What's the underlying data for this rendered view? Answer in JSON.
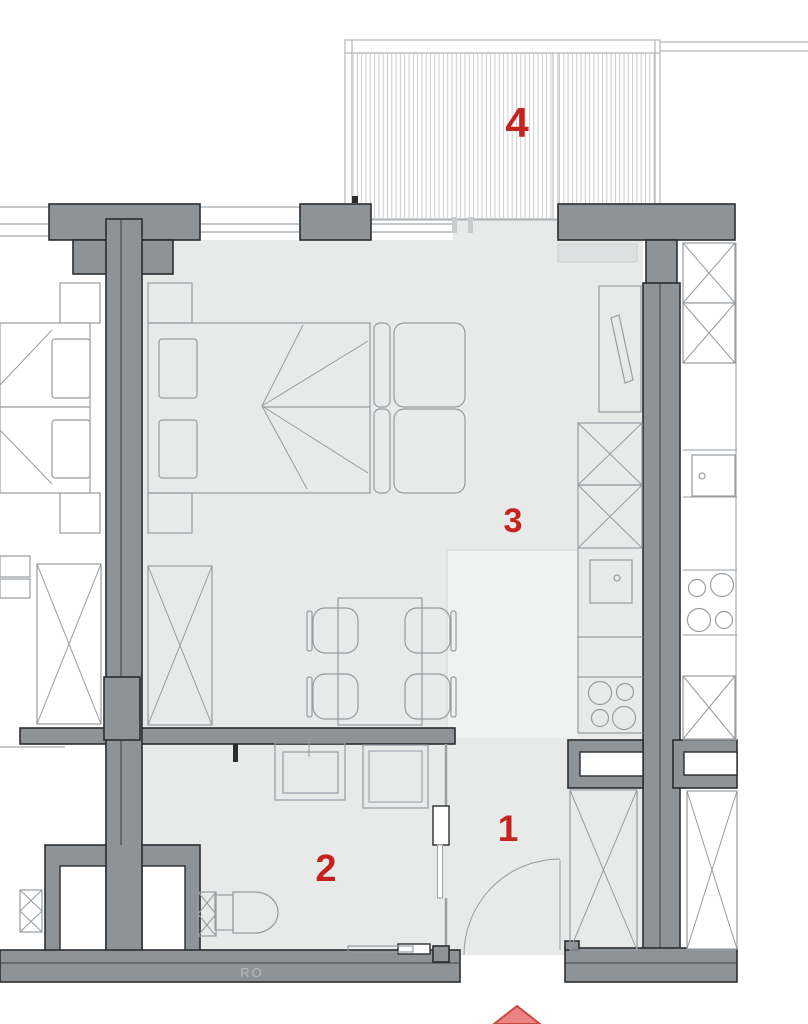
{
  "plan": {
    "room_labels": [
      {
        "label": "1"
      },
      {
        "label": "2"
      },
      {
        "label": "3"
      },
      {
        "label": "4"
      }
    ],
    "annotations": {
      "ro_label": "RO"
    },
    "palette": {
      "wall": "#8e9397",
      "wall-stroke": "#2b2d2f",
      "floor": "#e8e9e9",
      "floor-light": "#f0f1f1",
      "furniture-line": "#979ca1",
      "window-line": "#b2b6b9",
      "label-red": "#c4231e",
      "arrow-fill": "#ee8383",
      "arrow-stroke": "#c84a42"
    }
  }
}
